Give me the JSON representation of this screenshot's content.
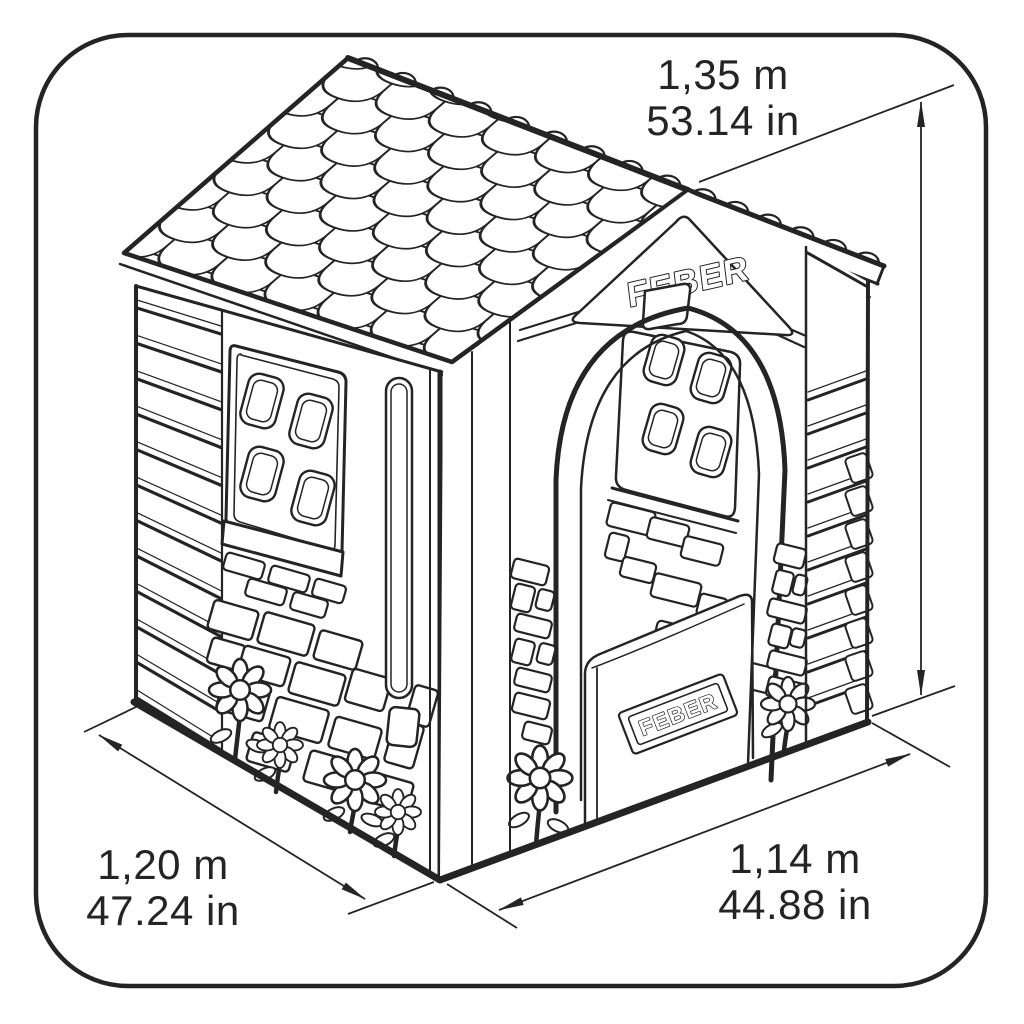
{
  "brand": {
    "gable_logo": "FEBER",
    "door_plaque_logo": "FEBER"
  },
  "dimensions": {
    "height": {
      "metric": "1,35 m",
      "imperial": "53.14 in"
    },
    "base_left": {
      "metric": "1,20 m",
      "imperial": "47.24 in"
    },
    "base_front": {
      "metric": "1,14 m",
      "imperial": "44.88 in"
    }
  },
  "style": {
    "line_color": "#242424",
    "border_color": "#242424",
    "background": "#ffffff"
  }
}
